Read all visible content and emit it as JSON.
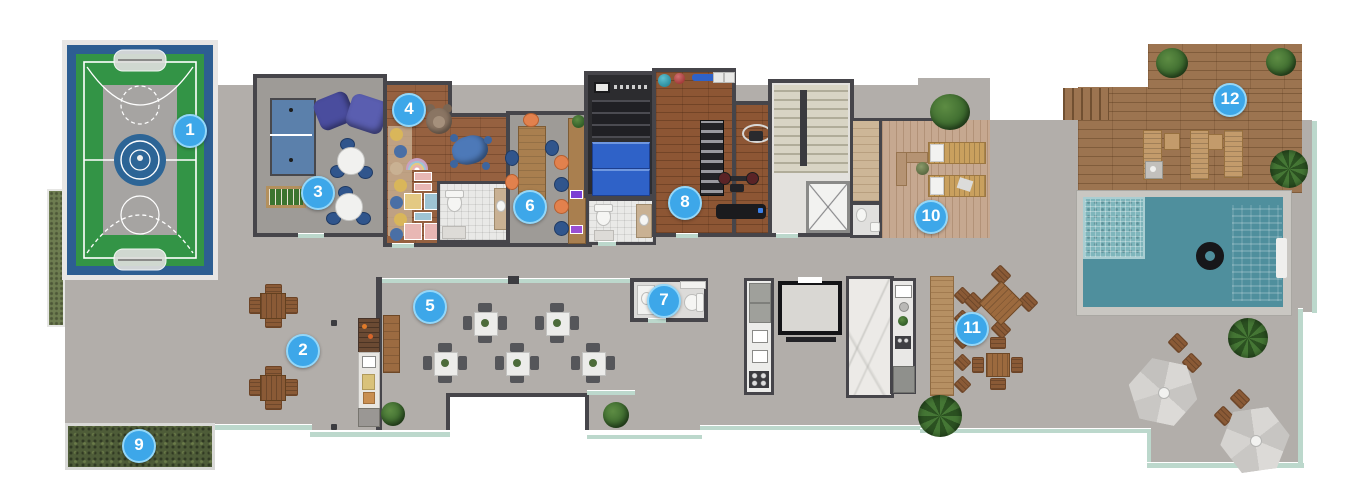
{
  "plan": {
    "markers": [
      {
        "label": "1",
        "area": "basketball-court",
        "x": 190,
        "y": 131
      },
      {
        "label": "2",
        "area": "terrace-tables",
        "x": 303,
        "y": 351
      },
      {
        "label": "3",
        "area": "games-room",
        "x": 318,
        "y": 193
      },
      {
        "label": "4",
        "area": "kids-playroom",
        "x": 409,
        "y": 110
      },
      {
        "label": "5",
        "area": "party-room",
        "x": 430,
        "y": 307
      },
      {
        "label": "6",
        "area": "coworking-room",
        "x": 530,
        "y": 207
      },
      {
        "label": "7",
        "area": "restroom",
        "x": 664,
        "y": 301
      },
      {
        "label": "8",
        "area": "gym",
        "x": 685,
        "y": 203
      },
      {
        "label": "9",
        "area": "garden-bed",
        "x": 139,
        "y": 446
      },
      {
        "label": "10",
        "area": "sun-deck",
        "x": 931,
        "y": 217
      },
      {
        "label": "11",
        "area": "gourmet-bar",
        "x": 972,
        "y": 329
      },
      {
        "label": "12",
        "area": "pool-deck",
        "x": 1230,
        "y": 100
      }
    ],
    "colors": {
      "marker_blue": "#3da7e9",
      "marker_ring": "#93d7f9",
      "wall": "#46454a",
      "deck_gray": "#b2aeaa",
      "court_green": "#339446",
      "court_blue": "#2d5e92",
      "pool_water": "#4f8f9d",
      "wood": "#9c7450",
      "garden_green": "#4e5c38",
      "gym_mat_blue": "#2f62c8",
      "glass_rail": "#bcd8cc"
    }
  }
}
